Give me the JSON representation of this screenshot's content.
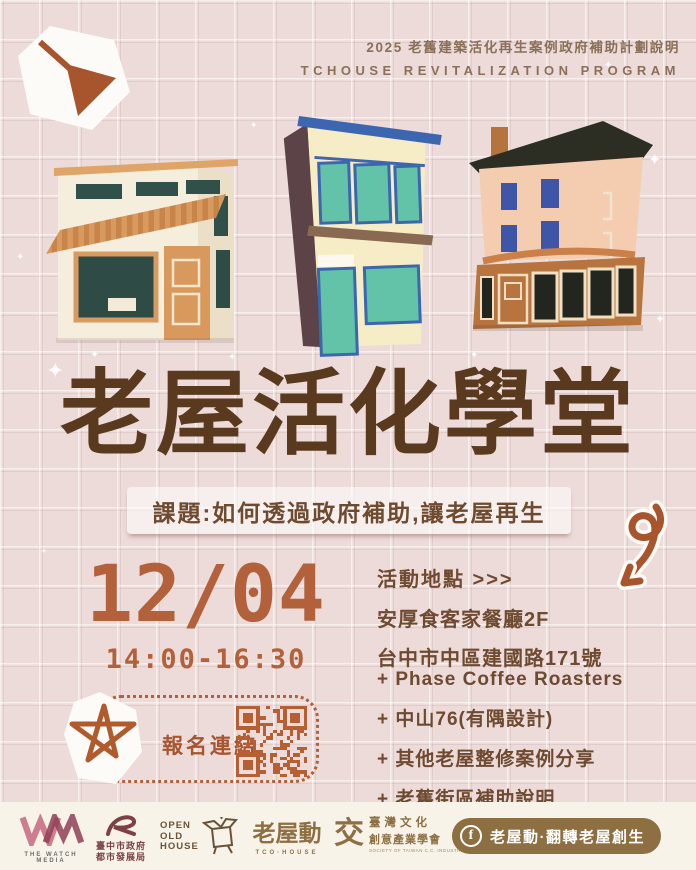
{
  "header": {
    "line1": "2025 老舊建築活化再生案例政府補助計劃說明",
    "line2": "TCHOUSE REVITALIZATION PROGRAM"
  },
  "title": "老屋活化學堂",
  "subtitle": "課題:如何透過政府補助,讓老屋再生",
  "schedule": {
    "date": "12/04",
    "time": "14:00-16:30"
  },
  "registration": {
    "label": "報名連結"
  },
  "location": {
    "heading": "活動地點 >>>",
    "venue": "安厚食客家餐廳2F",
    "address": "台中市中區建國路171號"
  },
  "agenda": {
    "items": [
      "+ Phase Coffee Roasters",
      "+ 中山76(有隅設計)",
      "+ 其他老屋整修案例分享",
      "+ 老舊街區補助說明"
    ]
  },
  "footer": {
    "watch_media": {
      "caption": "THE WATCH MEDIA"
    },
    "gov": {
      "name1": "臺中市政府",
      "name2": "都市發展局"
    },
    "open_old_house": {
      "l1": "OPEN",
      "l2": "OLD",
      "l3": "HOUSE"
    },
    "tco": {
      "logo": "老屋動",
      "caption": "TCO·HOUSE"
    },
    "society": {
      "glyph": "交",
      "name1": "臺灣文化",
      "name2": "創意產業學會",
      "caption": "SOCIETY OF TAIWAN C.C. INDUSTRIES"
    },
    "facebook": {
      "icon": "f",
      "label": "老屋動·翻轉老屋創生"
    }
  },
  "colors": {
    "background": "#ecdbd9",
    "title_brown": "#5a3a1f",
    "text_brown": "#6e4a31",
    "accent_terracotta": "#b2613a",
    "qr_orange": "#b65f33",
    "footer_bg": "#f7f3e9",
    "logo_brown": "#8d6f42"
  }
}
